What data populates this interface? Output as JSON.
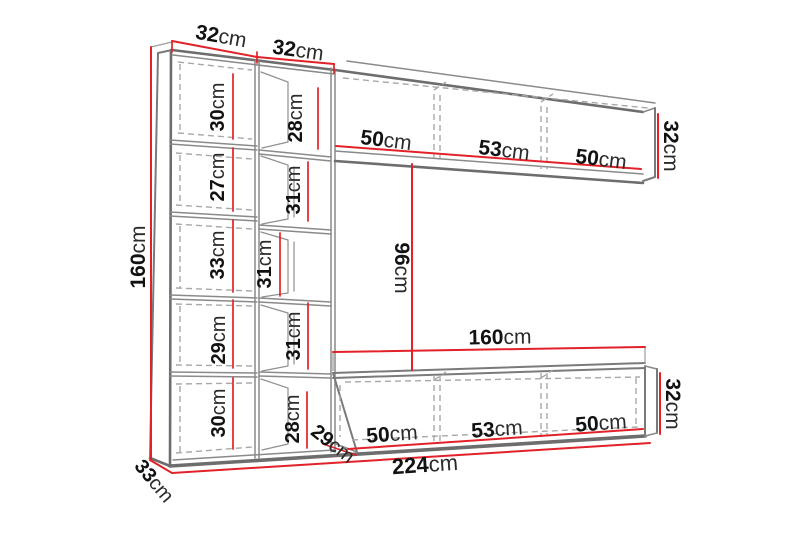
{
  "colors": {
    "dimension_line": "#e22128",
    "outline": "#6d6d6d",
    "hidden_line": "#a8a8a8",
    "label_text": "#121212",
    "background": "#ffffff"
  },
  "dimensions": {
    "top_column_widths": [
      "32cm",
      "32cm"
    ],
    "total_height": "160cm",
    "left_column_sections": [
      "30cm",
      "27cm",
      "33cm",
      "29cm",
      "30cm"
    ],
    "middle_column_sections": [
      "28cm",
      "31cm",
      "31cm",
      "31cm",
      "28cm"
    ],
    "top_shelf_sections": [
      "50cm",
      "53cm",
      "50cm"
    ],
    "top_shelf_height": "32cm",
    "center_gap_height": "96cm",
    "lower_cabinet_width": "160cm",
    "lower_cabinet_sections": [
      "50cm",
      "53cm",
      "50cm"
    ],
    "lower_cabinet_height": "32cm",
    "lower_cabinet_depth": "29cm",
    "total_width": "224cm",
    "side_depth": "33cm"
  }
}
